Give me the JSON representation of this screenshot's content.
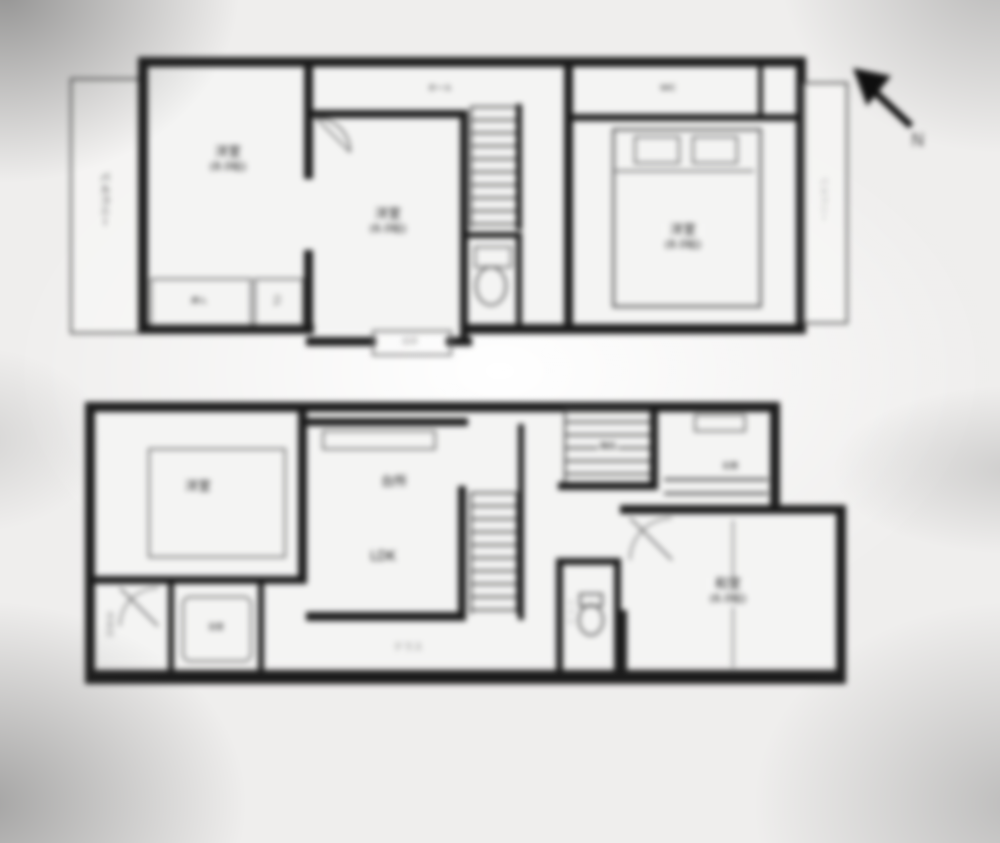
{
  "compass": {
    "letter": "N"
  },
  "floor2": {
    "balcony_left": "バルコニー",
    "balcony_right": "バルコニー",
    "hall": "ホール",
    "bay_window": "出窓",
    "closet_oshiire": "押入",
    "closet_cl": "CL",
    "closet_wic": "WIC",
    "rooms": [
      {
        "name": "洋室",
        "size": "(8.0帖)"
      },
      {
        "name": "洋室",
        "size": "(6.0帖)"
      },
      {
        "name": "洋室",
        "size": "(8.0帖)"
      }
    ]
  },
  "floor1": {
    "bedroom": {
      "name": "洋室"
    },
    "ldk": {
      "kitchen": "台所",
      "name": "LDK"
    },
    "washitsu": {
      "name": "和室",
      "size": "(6.0帖)"
    },
    "bath": "浴室",
    "washroom": "洗面所",
    "toilet": "トイレ",
    "stairs": "階段",
    "entrance": "玄関",
    "terrace": "テラス"
  }
}
